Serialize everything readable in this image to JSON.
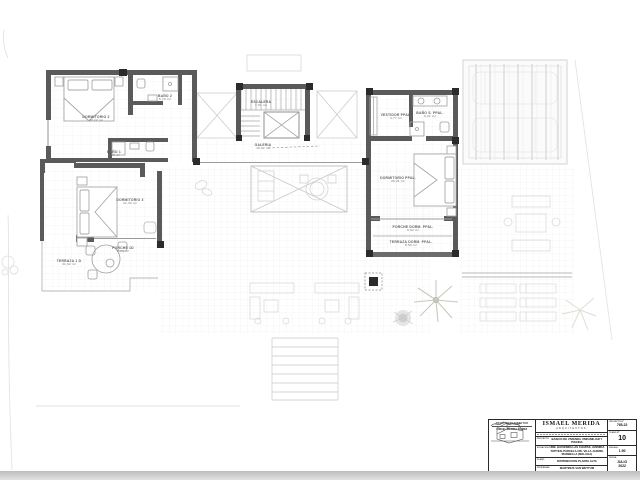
{
  "drawing": {
    "rooms": {
      "dormitorio2": {
        "name": "DORMITORIO 2",
        "area": "22,22 m²"
      },
      "bano2": {
        "name": "BAÑO 2",
        "area": "5,76 m²"
      },
      "bano1": {
        "name": "BAÑO 1",
        "area": "5,29 m²"
      },
      "escalera": {
        "name": "ESCALERA",
        "area": "7,91 m²"
      },
      "galeria": {
        "name": "GALERIA",
        "area": "18,02 m²"
      },
      "vestidor_ppal": {
        "name": "VESTIDOR PPAL.",
        "area": "4,77 m²"
      },
      "bano_ppal": {
        "name": "BAÑO S. PPAL.",
        "area": "6,21 m²"
      },
      "dormitorio_ppal": {
        "name": "DORMITORIO PPAL.",
        "area": "26,21 m²"
      },
      "porche_dorm_ppal": {
        "name": "PORCHE DORM. PPAL.",
        "area": "9,02 m²"
      },
      "terraza_dorm_ppal": {
        "name": "TERRAZA DORM. PPAL.",
        "area": "8,50 m²"
      },
      "dormitorio3": {
        "name": "DORMITORIO 3",
        "area": "21,34 m²"
      },
      "porche1d": {
        "name": "PORCHE 1D",
        "area": "3,74 m²"
      },
      "terraza1d": {
        "name": "TERRAZA 1 D",
        "area": "31,62 m²"
      }
    }
  },
  "title_block": {
    "firm_name": "ISMAEL MERIDA",
    "firm_subtitle": "ARQUITECTOS",
    "architect_caption": "ARQUITECTO DIRECTOR",
    "architect_name": "ISMAEL MERIDA GOMEZ",
    "rows": [
      {
        "label": "PROYECTO",
        "value": "BASICO DE VIVIENDA UNIFAMILIAR Y PISCINA"
      },
      {
        "label": "SITUACION",
        "value": "URB. HACIENDA LAS CHAPAS, AVENIDA TOPTEN, PARCELA 235, VILLA JAZMIN, MARBELLA (MALAGA)"
      },
      {
        "label": "PLANO",
        "value": "DISTRIBUCION PLANTA ALTA"
      },
      {
        "label": "PROPIEDAD",
        "value": "MARTINUS VAN WETTUM"
      }
    ],
    "meta": {
      "proyecto_num_label": "PROYECTO Nº",
      "proyecto_num": "765-22",
      "plano_num_label": "PLANO Nº",
      "plano_num": "10",
      "escala_label": "ESCALA",
      "escala": "1:50",
      "fecha_label": "FECHA",
      "fecha_month": "JULIO",
      "fecha_year": "2022"
    }
  },
  "colors": {
    "wall": "#5a5a5a",
    "column": "#2b2b2b",
    "grid": "#ededed",
    "faint": "#d7d7d7"
  }
}
